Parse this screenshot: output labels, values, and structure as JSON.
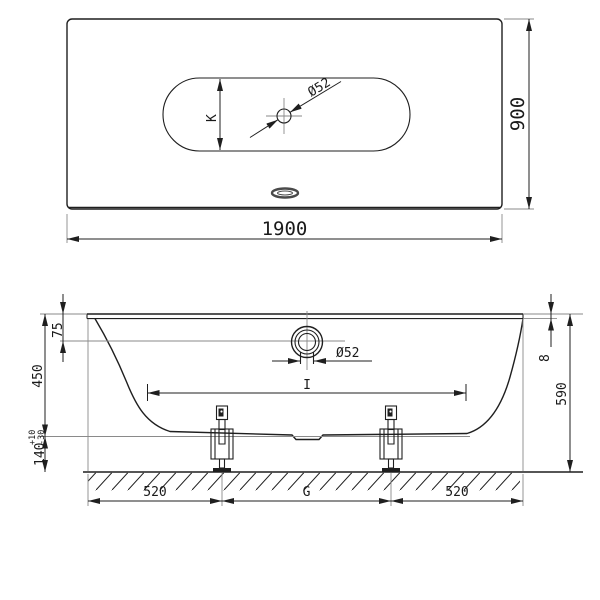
{
  "colors": {
    "line": "#1f1f1f",
    "auxiliary_line": "#8a8a8a",
    "background": "#ffffff"
  },
  "plan_view": {
    "overall_width": "1900",
    "overall_depth": "900",
    "interior_width": "K",
    "waste_diameter": "Ø52"
  },
  "side_view": {
    "rim_to_overflow": "75",
    "interior_depth": "450",
    "floor_clearance": "140",
    "clearance_tol_plus": "+10",
    "clearance_tol_minus": "-30",
    "rim_height": "8",
    "overall_height": "590",
    "overflow_diameter": "Ø52",
    "interior_length": "I",
    "foot_inset_left": "520",
    "foot_spacing": "G",
    "foot_inset_right": "520"
  }
}
